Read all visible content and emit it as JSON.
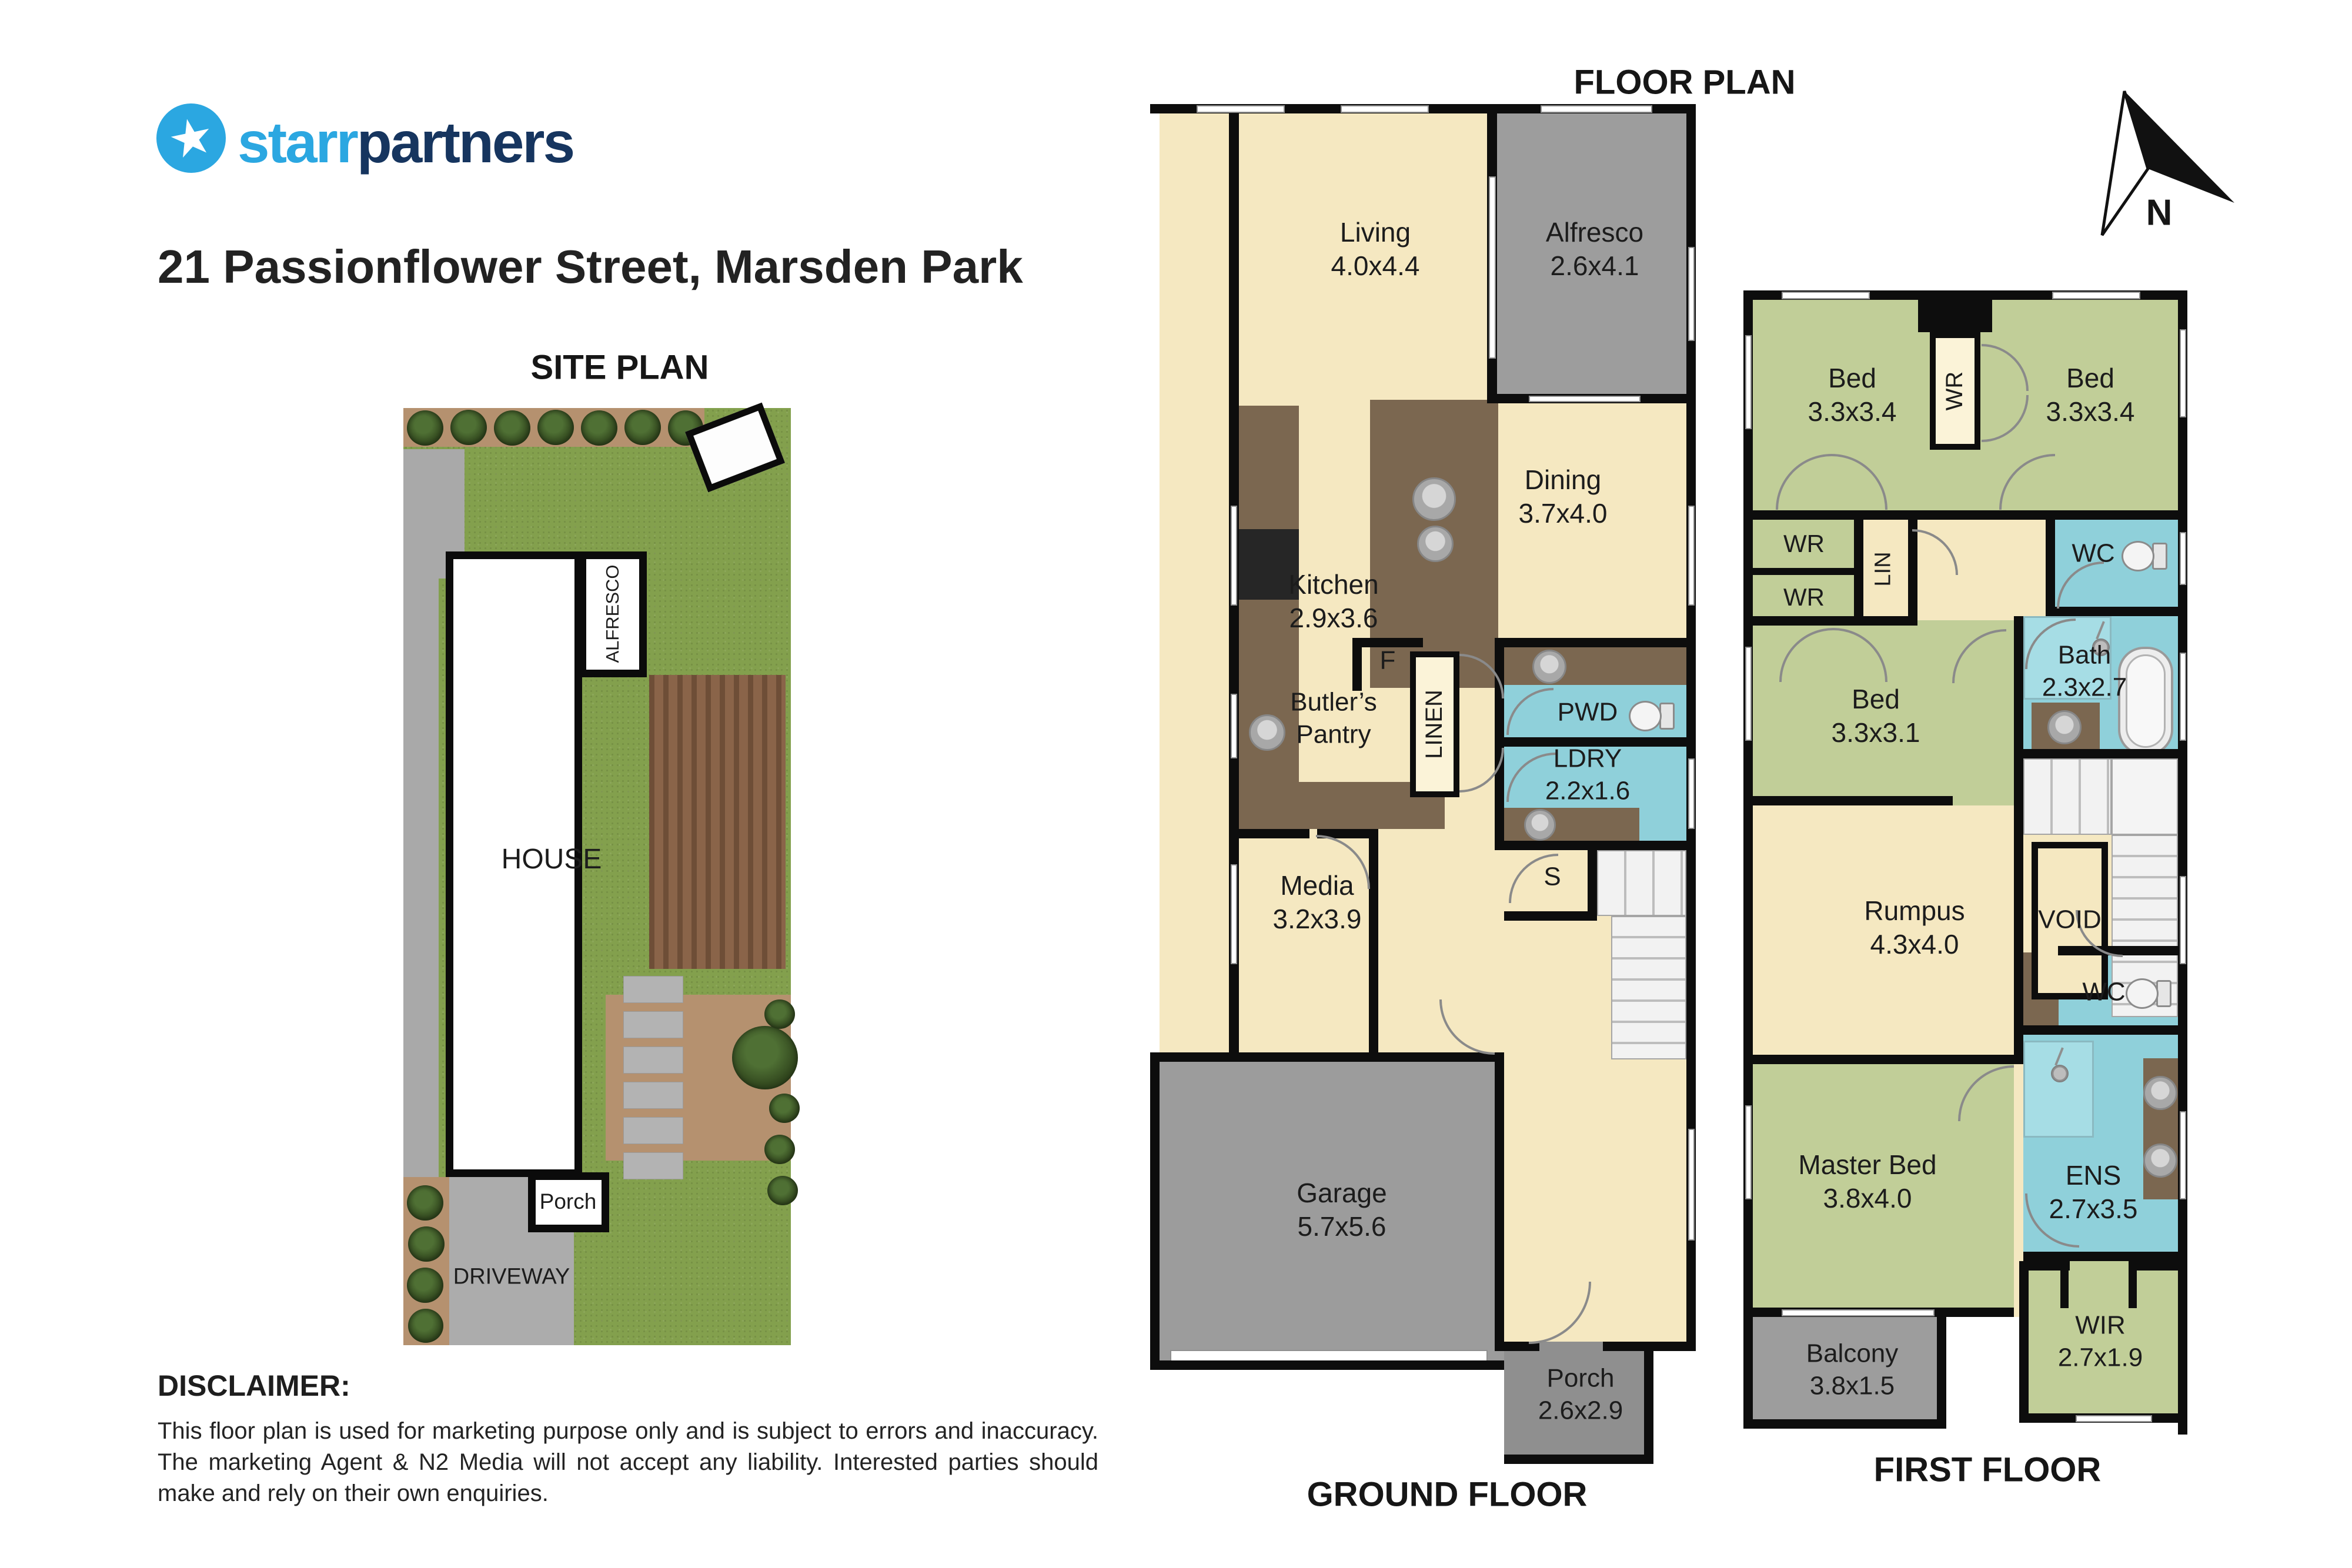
{
  "header": {
    "brand": {
      "star": "★",
      "first": "starr",
      "second": "partners"
    },
    "address": "21 Passionflower Street, Marsden Park",
    "site_plan_title": "SITE PLAN",
    "floor_plan_title": "FLOOR PLAN",
    "north": "N"
  },
  "site_plan": {
    "alfresco": "ALFRESCO",
    "house": "HOUSE",
    "porch": "Porch",
    "driveway": "DRIVEWAY"
  },
  "ground_floor": {
    "caption": "GROUND FLOOR",
    "living": {
      "line1": "Living",
      "line2": "4.0x4.4"
    },
    "alfresco": {
      "line1": "Alfresco",
      "line2": "2.6x4.1"
    },
    "dining": {
      "line1": "Dining",
      "line2": "3.7x4.0"
    },
    "kitchen": {
      "line1": "Kitchen",
      "line2": "2.9x3.6"
    },
    "fridge": "F",
    "butlers": {
      "line1": "Butler’s",
      "line2": "Pantry"
    },
    "linen": "LINEN",
    "pwd": "PWD",
    "ldry": {
      "line1": "LDRY",
      "line2": "2.2x1.6"
    },
    "store": "S",
    "media": {
      "line1": "Media",
      "line2": "3.2x3.9"
    },
    "garage": {
      "line1": "Garage",
      "line2": "5.7x5.6"
    },
    "porch": {
      "line1": "Porch",
      "line2": "2.6x2.9"
    }
  },
  "first_floor": {
    "caption": "FIRST FLOOR",
    "bed1": {
      "line1": "Bed",
      "line2": "3.3x3.4"
    },
    "bed2": {
      "line1": "Bed",
      "line2": "3.3x3.4"
    },
    "wr_mid": "WR",
    "wr_a": "WR",
    "wr_b": "WR",
    "lin": "LIN",
    "wc_upper": "WC",
    "bath": {
      "line1": "Bath",
      "line2": "2.3x2.7"
    },
    "bed3": {
      "line1": "Bed",
      "line2": "3.3x3.1"
    },
    "rumpus": {
      "line1": "Rumpus",
      "line2": "4.3x4.0"
    },
    "void_label": "VOID",
    "wc_lower": "WC",
    "master": {
      "line1": "Master Bed",
      "line2": "3.8x4.0"
    },
    "ens": {
      "line1": "ENS",
      "line2": "2.7x3.5"
    },
    "wir": {
      "line1": "WIR",
      "line2": "2.7x1.9"
    },
    "balcony": {
      "line1": "Balcony",
      "line2": "3.8x1.5"
    }
  },
  "disclaimer": {
    "heading": "DISCLAIMER:",
    "body": "This floor plan is used for marketing purpose only and is subject to errors and inaccuracy. The marketing Agent & N2 Media will not accept any liability. Interested parties should make and rely on their own enquiries."
  },
  "colors": {
    "brand_first": "#2ba7e1",
    "brand_second": "#16355f",
    "floor_cream": "#f5e8c1",
    "room_green": "#c1ce98",
    "wet_blue": "#8fd0da",
    "bench_brown": "#7b6750",
    "outdoor_grey": "#9d9d9d",
    "wall_black": "#0d0d0d"
  }
}
